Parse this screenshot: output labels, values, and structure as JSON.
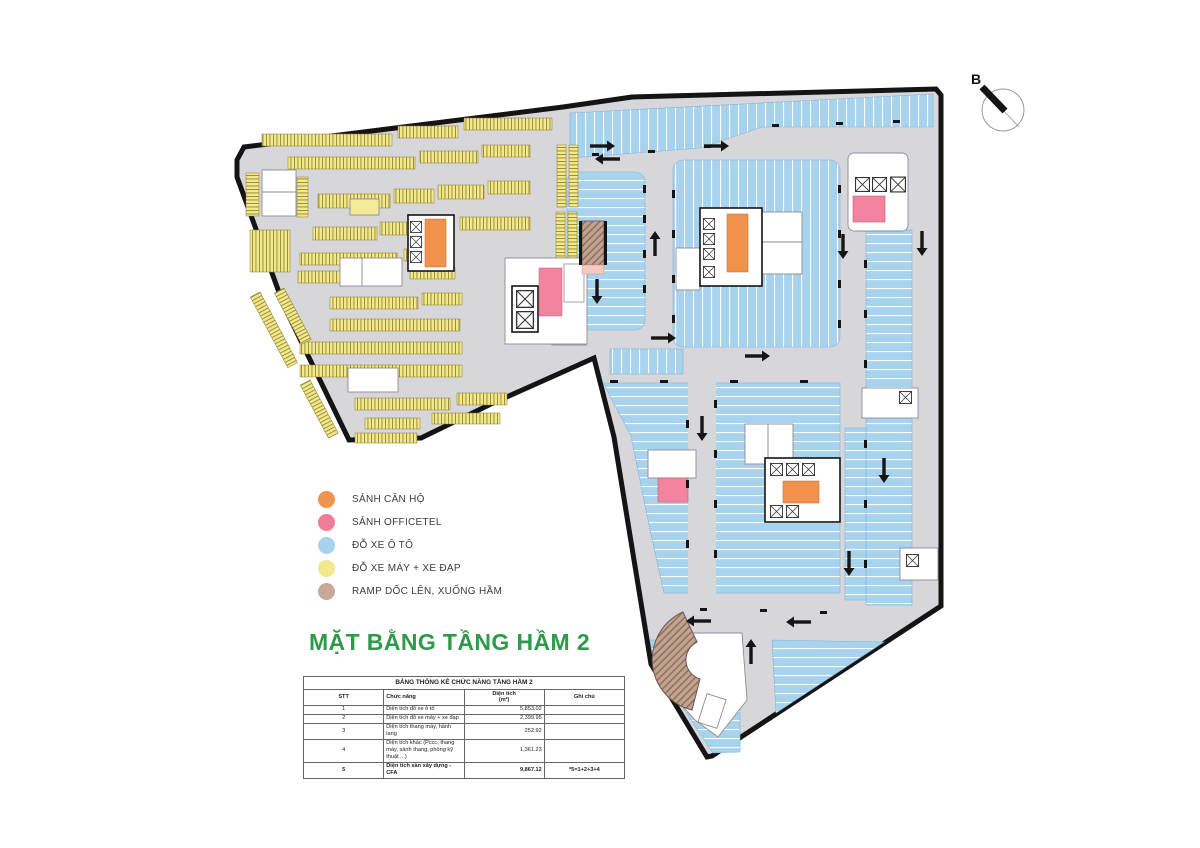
{
  "compass": {
    "label": "B"
  },
  "legend": {
    "items": [
      {
        "name": "apartment-lobby",
        "label": "SẢNH CĂN HỘ",
        "color": "#F0934E"
      },
      {
        "name": "officetel-lobby",
        "label": "SẢNH OFFICETEL",
        "color": "#F07D96"
      },
      {
        "name": "car-parking",
        "label": "ĐỖ XE Ô TÔ",
        "color": "#A8D3EE"
      },
      {
        "name": "moto-bike-parking",
        "label": "ĐỖ XE MÁY + XE ĐẠP",
        "color": "#F2E88E"
      },
      {
        "name": "ramp",
        "label": "RAMP DỐC LÊN, XUỐNG HẦM",
        "color": "#C9A897"
      }
    ]
  },
  "title": "MẶT BẰNG TẦNG HẦM 2",
  "table": {
    "title": "BẢNG THỐNG KÊ CHỨC NĂNG TẦNG HẦM 2",
    "col_stt": "STT",
    "col_function": "Chức năng",
    "col_area_line1": "Diện tích",
    "col_area_line2": "(m²)",
    "col_note": "Ghi chú",
    "rows": [
      {
        "stt": "1",
        "function": "Diện tích đỗ xe ô tô",
        "area": "5,853.02",
        "note": ""
      },
      {
        "stt": "2",
        "function": "Diện tích đỗ xe máy + xe đạp",
        "area": "2,399.95",
        "note": ""
      },
      {
        "stt": "3",
        "function": "Diện tích thang máy, hành lang",
        "area": "252.92",
        "note": ""
      },
      {
        "stt": "4",
        "function": "Diện tích khác (Pccc, thang máy, sảnh thang, phòng kỹ thuật ...)",
        "area": "1,361.23",
        "note": ""
      },
      {
        "stt": "5",
        "function": "Diện tích sàn xây dựng - CFA",
        "area": "9,867.12",
        "note": "*5=1+2+3+4"
      }
    ]
  },
  "plan_colors": {
    "floor": "#D7D7DB",
    "boundary": "#141414",
    "car_blue": "#A8D3EE",
    "moto_yellow": "#F2E88E",
    "lobby_orange": "#F0914C",
    "officetel_pink": "#F2849E",
    "ramp_brown": "#C2A291"
  }
}
